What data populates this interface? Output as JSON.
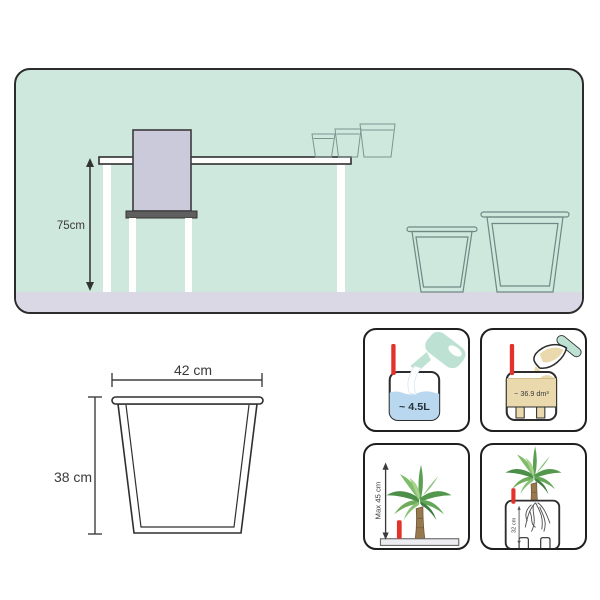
{
  "scene": {
    "table_height_label": "75cm",
    "description": "room-scene-with-table-chair-and-planters"
  },
  "dimensions": {
    "width_label": "42 cm",
    "height_label": "38 cm"
  },
  "features": {
    "water_volume": "~ 4.5L",
    "substrate_volume": "~ 36.9 dm³",
    "max_plant_height": "Max 45 cm",
    "planting_depth": "32 cm"
  },
  "icons": {
    "watering_can": "watering-can-icon",
    "trowel": "trowel-icon",
    "plant": "plant-icon",
    "roots": "roots-icon",
    "water_level_indicator": "water-level-indicator-icon",
    "dimension_arrow": "dimension-arrow-icon"
  },
  "colors": {
    "wall": "#cfe8de",
    "floor": "#d9d8e4",
    "chair": "#cbcadb",
    "seat": "#5f5f5f",
    "water": "#b9d8f0",
    "substrate": "#ead9ad",
    "mint_accent": "#bde2d3",
    "indicator_red": "#e2322a",
    "outline": "#2d2d2d",
    "planter_line": "#6f8884"
  }
}
